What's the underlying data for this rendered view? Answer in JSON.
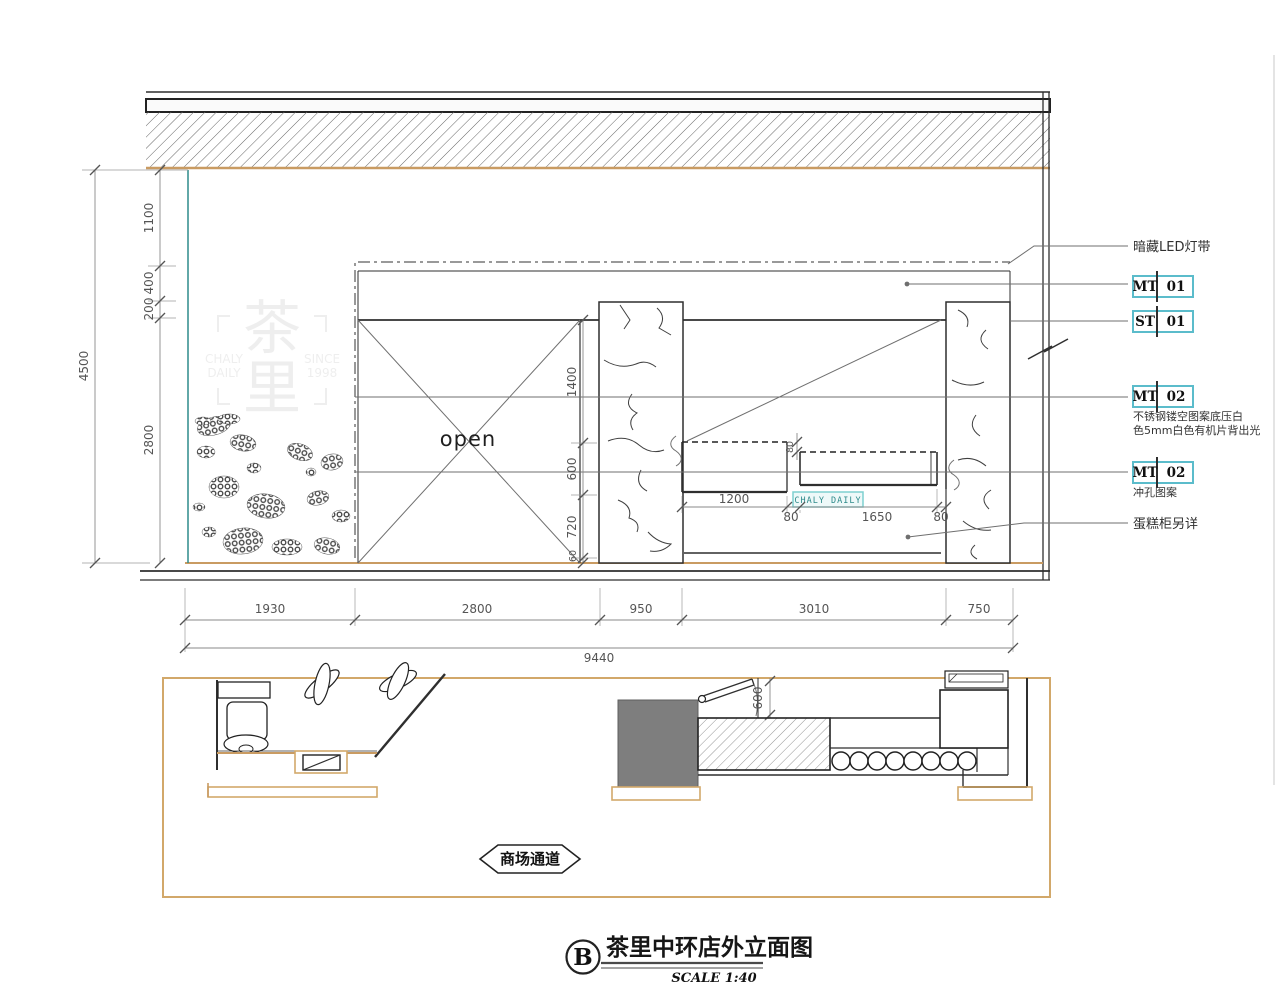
{
  "title_block": {
    "ref": "B",
    "title": "茶里中环店外立面图",
    "scale": "SCALE 1:40"
  },
  "elevation": {
    "open_label": "open",
    "sign": "CHALY DAILY",
    "colors": {
      "tan": "#c99b62",
      "teal": "#2e8b8b",
      "tag_box_border": "#5bbccb",
      "gray_block": "#7e7e7e"
    }
  },
  "watermark": {
    "char_top": "茶",
    "char_bottom": "里",
    "left_line1": "CHALY",
    "left_line2": "DAILY",
    "right_line1": "SINCE",
    "right_line2": "1998"
  },
  "annotations": {
    "led": "暗藏LED灯带",
    "tags": [
      {
        "code": "MT",
        "num": "01"
      },
      {
        "code": "ST",
        "num": "01"
      },
      {
        "code": "MT",
        "num": "02"
      },
      {
        "code": "MT",
        "num": "02"
      }
    ],
    "mt02_note_line1": "不锈钢镂空图案底压白",
    "mt02_note_line2": "色5mm白色有机片背出光",
    "mt02b_note": "冲孔图案",
    "cake_note": "蛋糕柜另详"
  },
  "dims": {
    "left_total": "4500",
    "left_chain": [
      "1100",
      "400",
      "200",
      "2800"
    ],
    "mid_chain": [
      "1400",
      "600",
      "720",
      "60"
    ],
    "counter_gap": "80",
    "counter_chain": [
      "1200",
      "80",
      "1650",
      "80"
    ],
    "bottom_chain": [
      "1930",
      "2800",
      "950",
      "3010",
      "750"
    ],
    "bottom_total": "9440",
    "plan_door": "600"
  },
  "plan": {
    "corridor": "商场通道"
  }
}
